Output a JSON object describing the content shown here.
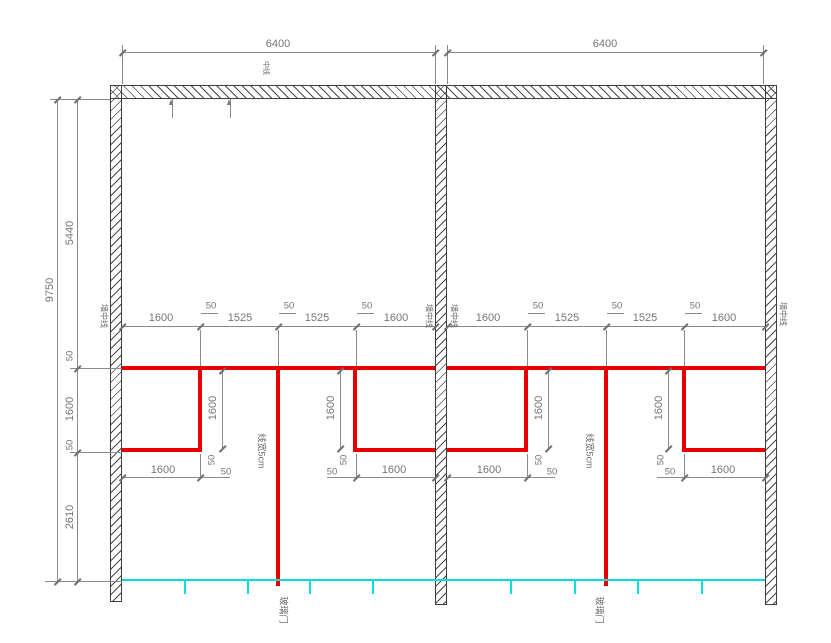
{
  "dims": {
    "bay_width": "6400",
    "total_height": "9750",
    "left_chain": [
      "5440",
      "50",
      "1600",
      "50",
      "2610"
    ],
    "bay_chain": [
      "1600",
      "50",
      "1525",
      "50",
      "1525",
      "50",
      "1600"
    ],
    "panel_depth": "1600",
    "tape_width_dim": "50"
  },
  "labels": {
    "tape_note": "线宽5cm",
    "glass_door": "玻璃门",
    "wall_axis": "墙中线",
    "center_axis": "中线"
  },
  "colors": {
    "tape_red": "#e60000",
    "glass_cyan": "#00dede",
    "dim_gray": "#8a8a8a"
  }
}
